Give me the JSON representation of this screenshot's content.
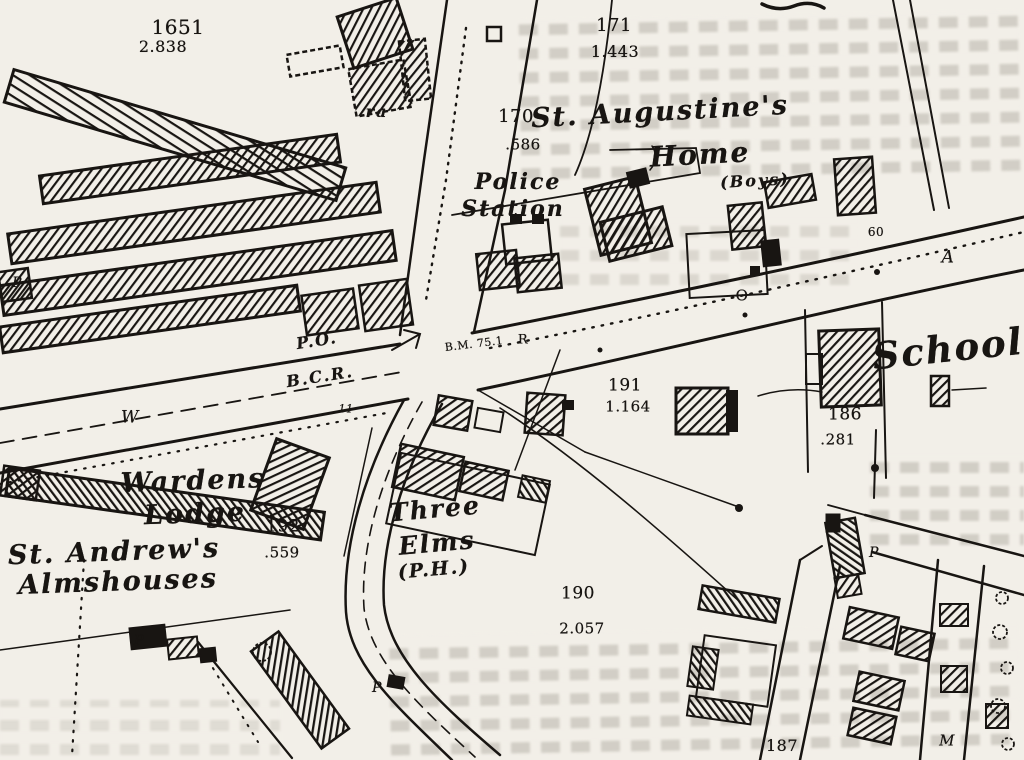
{
  "map": {
    "colors": {
      "paper": "#f2efe8",
      "ink": "#181512",
      "bleed_text": "#8a8378"
    },
    "place_labels": [
      {
        "text": "St. Augustine's",
        "x": 660,
        "y": 112,
        "size": 27,
        "italic": true,
        "rotate": -3
      },
      {
        "text": "Home",
        "x": 700,
        "y": 155,
        "size": 28,
        "italic": true,
        "rotate": -3
      },
      {
        "text": "(Boys)",
        "x": 755,
        "y": 181,
        "size": 16,
        "italic": true,
        "rotate": -3
      },
      {
        "text": "Police",
        "x": 518,
        "y": 182,
        "size": 22,
        "italic": true,
        "rotate": 0
      },
      {
        "text": "Station",
        "x": 513,
        "y": 209,
        "size": 22,
        "italic": true,
        "rotate": 0
      },
      {
        "text": "School",
        "x": 948,
        "y": 349,
        "size": 37,
        "italic": true,
        "rotate": -6
      },
      {
        "text": "Wardens",
        "x": 193,
        "y": 481,
        "size": 27,
        "italic": true,
        "rotate": -2
      },
      {
        "text": "Lodge",
        "x": 195,
        "y": 514,
        "size": 27,
        "italic": true,
        "rotate": -2
      },
      {
        "text": "St. Andrew's",
        "x": 114,
        "y": 552,
        "size": 27,
        "italic": true,
        "rotate": -2
      },
      {
        "text": "Almshouses",
        "x": 118,
        "y": 582,
        "size": 27,
        "italic": true,
        "rotate": -2
      },
      {
        "text": "Three",
        "x": 435,
        "y": 509,
        "size": 25,
        "italic": true,
        "rotate": -5
      },
      {
        "text": "Elms",
        "x": 437,
        "y": 543,
        "size": 25,
        "italic": true,
        "rotate": -5
      },
      {
        "text": "(P.H.)",
        "x": 434,
        "y": 570,
        "size": 19,
        "italic": true,
        "rotate": -5
      },
      {
        "text": "P.O.",
        "x": 317,
        "y": 341,
        "size": 16,
        "italic": true,
        "rotate": -9
      },
      {
        "text": "B.C.R.",
        "x": 320,
        "y": 377,
        "size": 16,
        "italic": true,
        "rotate": -9
      },
      {
        "text": "ra",
        "x": 377,
        "y": 112,
        "size": 16,
        "italic": true,
        "rotate": 0
      }
    ],
    "parcel_labels": [
      {
        "text": "1651",
        "x": 178,
        "y": 27,
        "size": 20
      },
      {
        "text": "2.838",
        "x": 163,
        "y": 47,
        "size": 16
      },
      {
        "text": "171",
        "x": 614,
        "y": 26,
        "size": 18
      },
      {
        "text": "1.443",
        "x": 615,
        "y": 52,
        "size": 16
      },
      {
        "text": "170",
        "x": 516,
        "y": 117,
        "size": 18
      },
      {
        "text": ".586",
        "x": 523,
        "y": 145,
        "size": 15
      },
      {
        "text": "191",
        "x": 625,
        "y": 386,
        "size": 17
      },
      {
        "text": "1.164",
        "x": 628,
        "y": 407,
        "size": 15
      },
      {
        "text": "186",
        "x": 845,
        "y": 415,
        "size": 17
      },
      {
        "text": ".281",
        "x": 838,
        "y": 440,
        "size": 15
      },
      {
        "text": "192",
        "x": 283,
        "y": 527,
        "size": 17
      },
      {
        "text": ".559",
        "x": 282,
        "y": 553,
        "size": 15
      },
      {
        "text": "190",
        "x": 578,
        "y": 594,
        "size": 17
      },
      {
        "text": "2.057",
        "x": 582,
        "y": 629,
        "size": 15
      },
      {
        "text": "187",
        "x": 782,
        "y": 746,
        "size": 16
      }
    ],
    "small_labels": [
      {
        "text": "P",
        "x": 17,
        "y": 283,
        "size": 14,
        "italic": true
      },
      {
        "text": "W",
        "x": 130,
        "y": 418,
        "size": 17,
        "italic": true
      },
      {
        "text": "P",
        "x": 139,
        "y": 641,
        "size": 14,
        "italic": true
      },
      {
        "text": "P",
        "x": 377,
        "y": 688,
        "size": 14,
        "italic": true
      },
      {
        "text": "P",
        "x": 874,
        "y": 553,
        "size": 14,
        "italic": true
      },
      {
        "text": "M",
        "x": 947,
        "y": 741,
        "size": 15,
        "italic": true
      },
      {
        "text": "O",
        "x": 742,
        "y": 296,
        "size": 15
      },
      {
        "text": "A",
        "x": 948,
        "y": 258,
        "size": 17,
        "italic": true
      },
      {
        "text": "60",
        "x": 876,
        "y": 232,
        "size": 12
      },
      {
        "text": "B.M. 75.1",
        "x": 474,
        "y": 344,
        "size": 11,
        "rotate": -7
      },
      {
        "text": "R",
        "x": 523,
        "y": 340,
        "size": 13
      },
      {
        "text": "11",
        "x": 346,
        "y": 409,
        "size": 11,
        "italic": true
      }
    ]
  }
}
